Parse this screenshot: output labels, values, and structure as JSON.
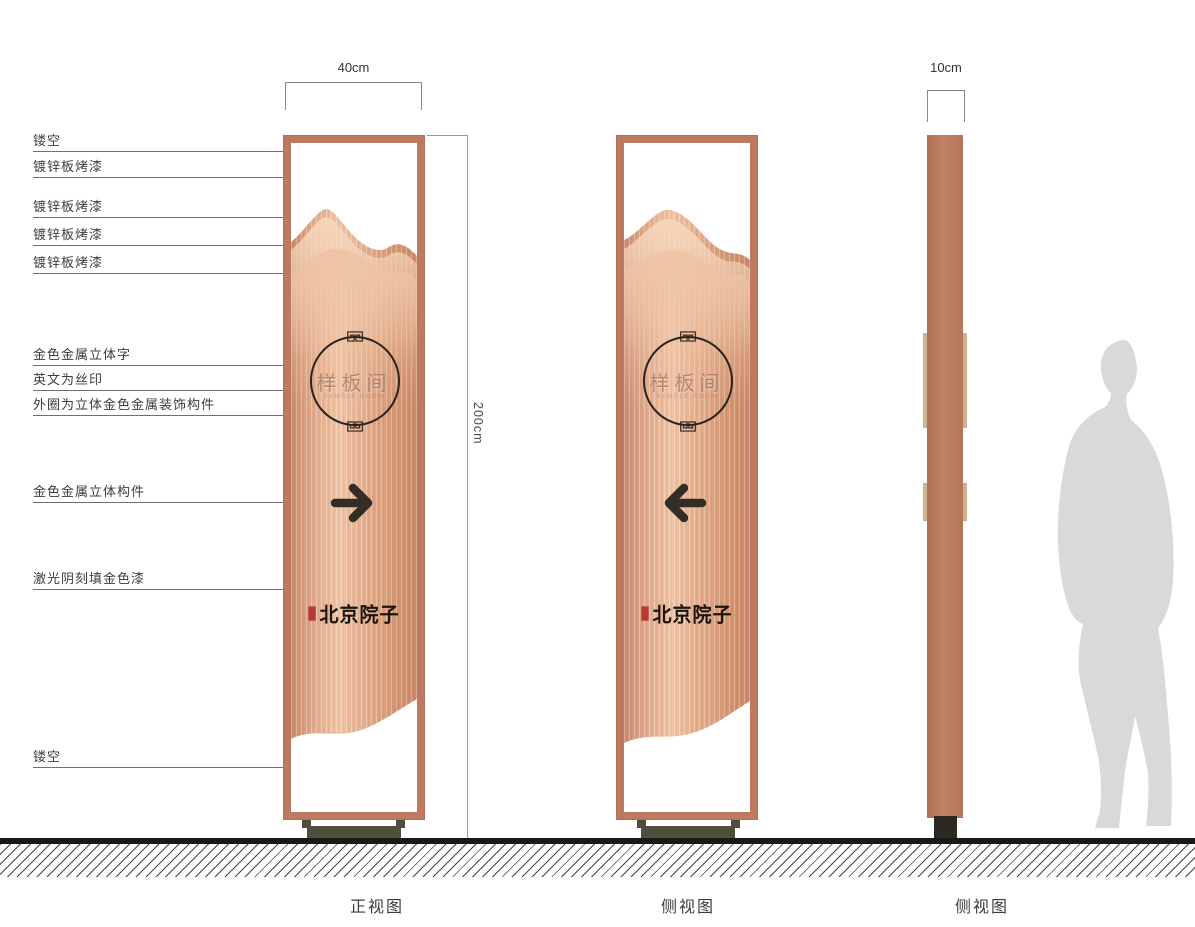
{
  "annotations": {
    "items": [
      {
        "label": "镂空"
      },
      {
        "label": "镀锌板烤漆"
      },
      {
        "label": "镀锌板烤漆"
      },
      {
        "label": "镀锌板烤漆"
      },
      {
        "label": "镀锌板烤漆"
      },
      {
        "label": "金色金属立体字"
      },
      {
        "label": "英文为丝印"
      },
      {
        "label": "外圈为立体金色金属装饰构件"
      },
      {
        "label": "金色金属立体构件"
      },
      {
        "label": "激光阴刻填金色漆"
      },
      {
        "label": "镂空"
      }
    ]
  },
  "dimensions": {
    "front_width": "40cm",
    "height": "200cm",
    "side_width": "10cm"
  },
  "sign": {
    "room_name": "样板间",
    "room_subtext": "SAMPLE ROOM",
    "brand_name": "北京院子"
  },
  "captions": {
    "front": "正视图",
    "side": "侧视图",
    "side2": "侧视图"
  },
  "colors": {
    "frame_copper": "#bd7a60",
    "panel_light": "#f0c4a5",
    "panel_dark": "#c98a6c",
    "ring_dark": "#2b241d",
    "arrow_dark": "#332d26",
    "gold_text": "#8a5f40",
    "seal_red": "#b63b30",
    "tab_tan": "#cdb392",
    "foot_olive": "#504d3a",
    "ground_black": "#191919",
    "silhouette_gray": "#d9d9dc"
  }
}
